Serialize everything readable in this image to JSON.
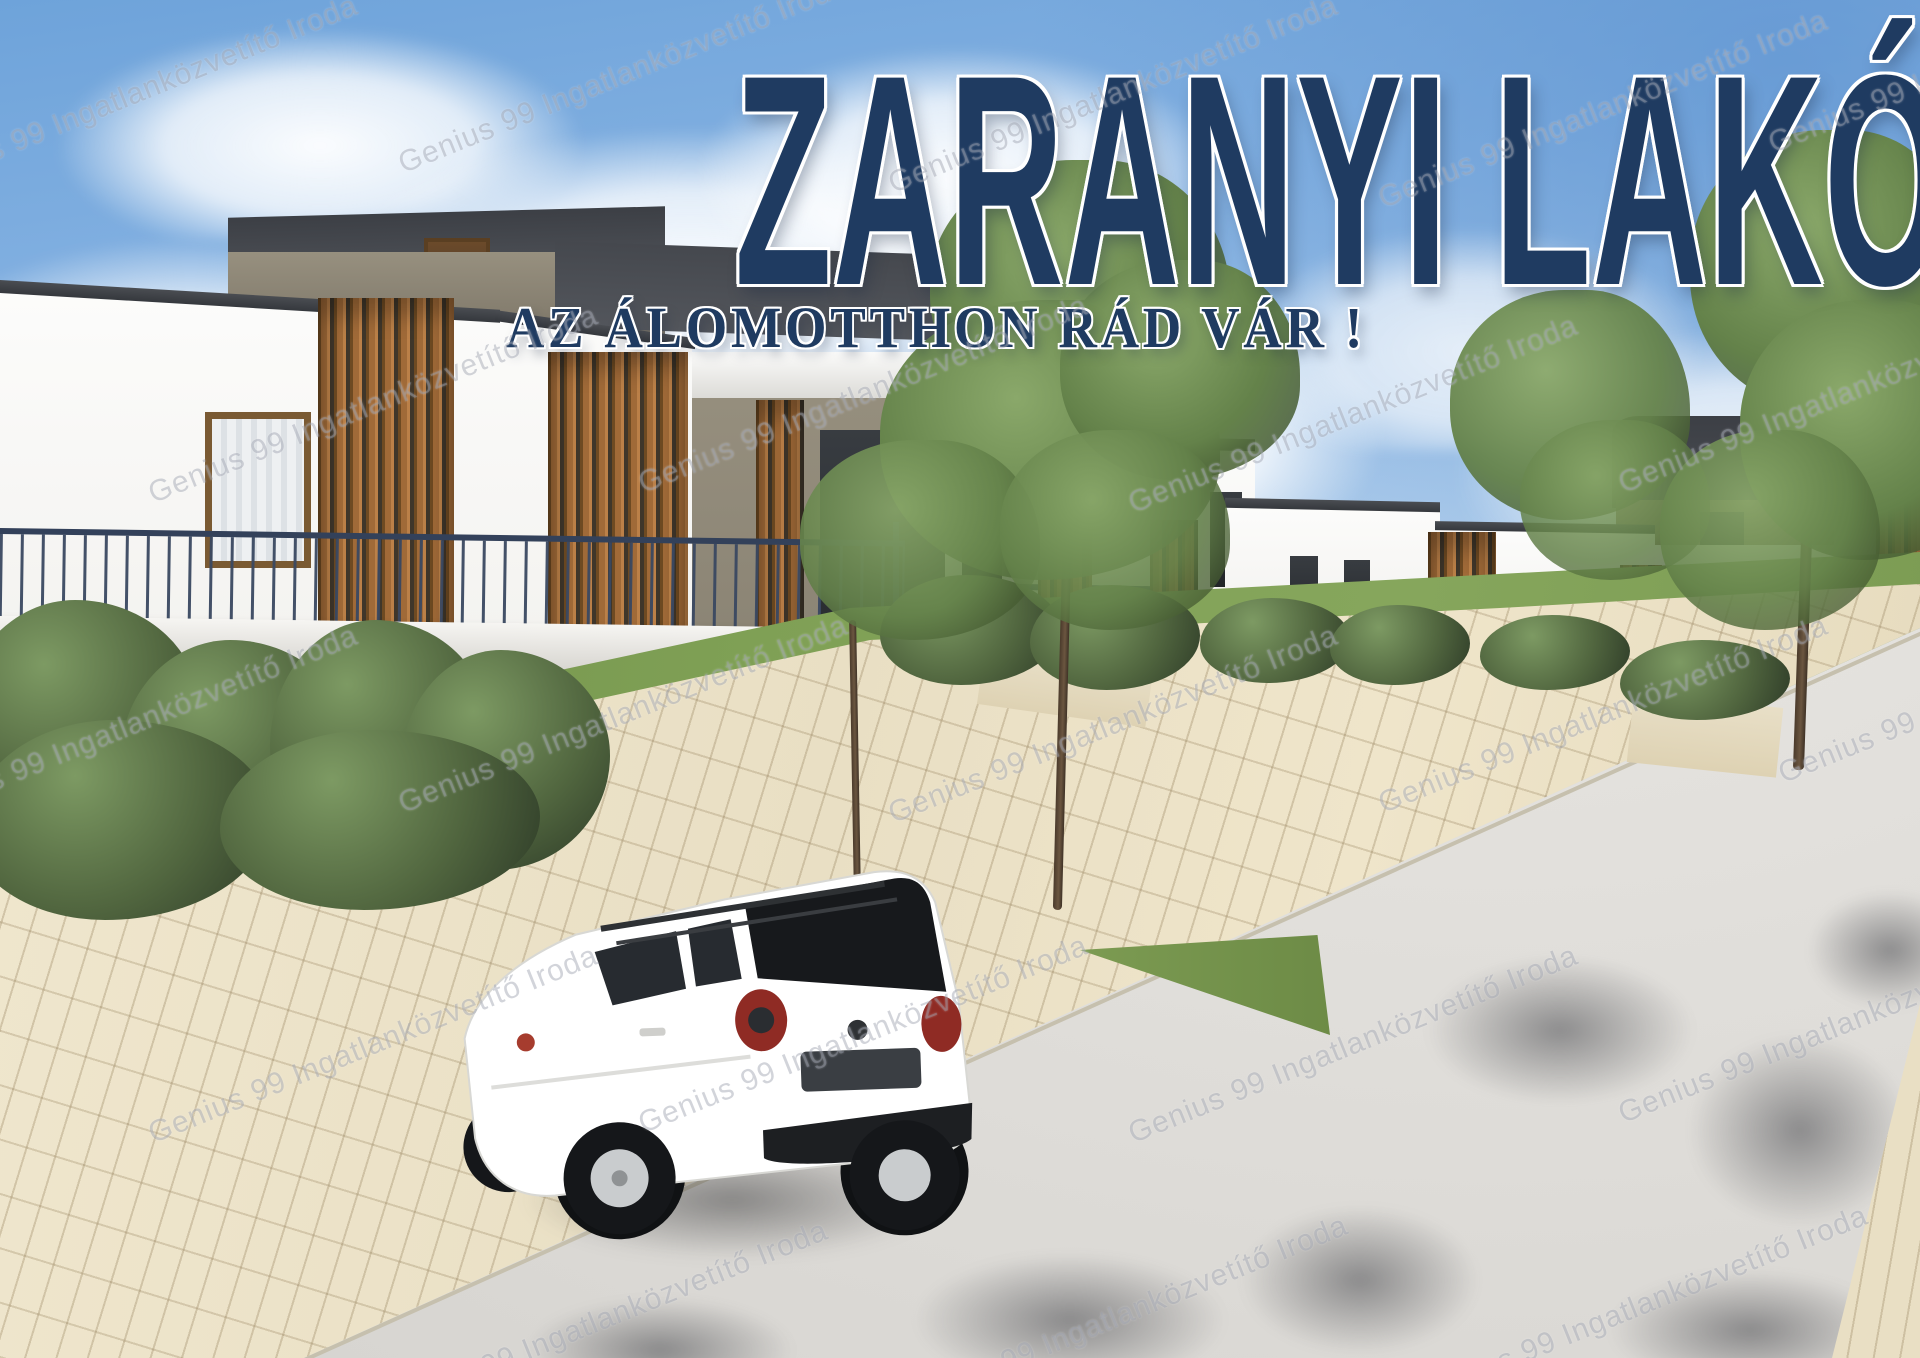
{
  "poster": {
    "title": "ZARANYI LAKÓPARK",
    "subtitle": "AZ ÁLOMOTTHON RÁD VÁR !",
    "watermark": "Genius 99 Ingatlanközvetítő Iroda"
  },
  "palette": {
    "title-navy": "#1f3b61",
    "railing-steel": "#3a4861",
    "wood": "#a06a38",
    "wood-dark": "#6e4a22",
    "roof-charcoal": "#42454b",
    "attic-taupe": "#8f887a",
    "paver-beige": "#e9dfc4",
    "road-gray": "#dedcd8",
    "hedge-green": "#46583a",
    "grass-green": "#78974f",
    "tree-green": "#6e8d52",
    "brick-taupe": "#877c66",
    "car-white": "#ffffff",
    "taillight-red": "#8f2b24",
    "sky-blue": "#6ea3da",
    "cloud-white": "#ffffff"
  }
}
